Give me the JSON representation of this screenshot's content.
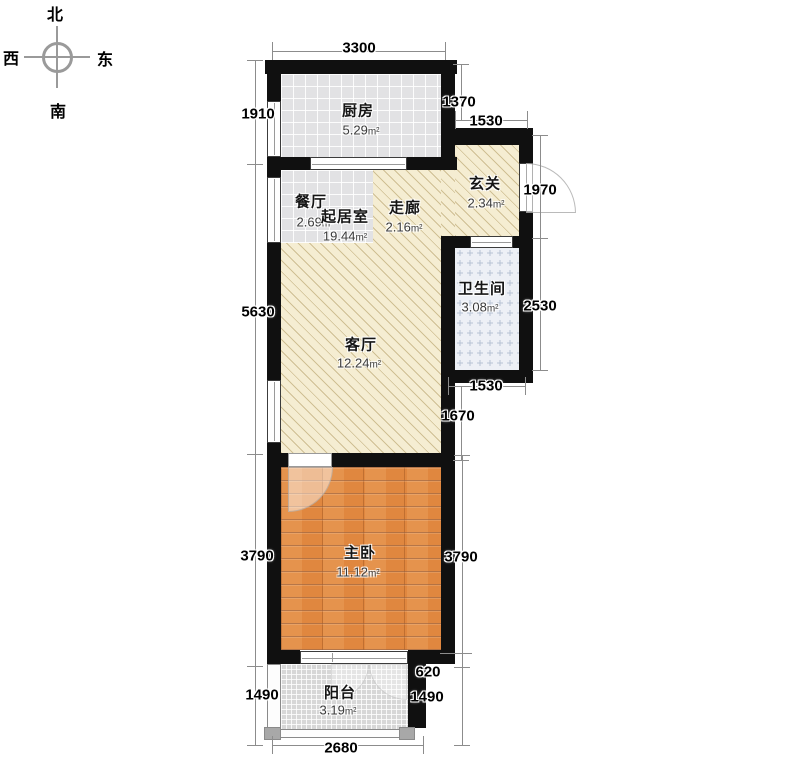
{
  "compass": {
    "north": "北",
    "south": "南",
    "east": "东",
    "west": "西"
  },
  "rooms": {
    "kitchen": {
      "name": "厨房",
      "area": "5.29",
      "unit": "m²"
    },
    "dining": {
      "name": "餐厅",
      "area": "2.69",
      "unit": "m²"
    },
    "living_suite": {
      "name": "起居室",
      "area": "19.44",
      "unit": "m²"
    },
    "corridor": {
      "name": "走廊",
      "area": "2.16",
      "unit": "m²"
    },
    "foyer": {
      "name": "玄关",
      "area": "2.34",
      "unit": "m²"
    },
    "bathroom": {
      "name": "卫生间",
      "area": "3.08",
      "unit": "m²"
    },
    "livingroom": {
      "name": "客厅",
      "area": "12.24",
      "unit": "m²"
    },
    "bedroom": {
      "name": "主卧",
      "area": "11.12",
      "unit": "m²"
    },
    "balcony": {
      "name": "阳台",
      "area": "3.19",
      "unit": "m²"
    }
  },
  "dims": {
    "top_width": "3300",
    "kitchen_left": "1910",
    "kitchen_right": "1370",
    "foyer_top": "1530",
    "foyer_right": "1970",
    "living_left": "5630",
    "bathroom_right": "2530",
    "bathroom_bottom": "1530",
    "living_right": "1670",
    "bedroom_left": "3790",
    "bedroom_right": "3790",
    "balcony_offset": "620",
    "balcony_left": "1490",
    "balcony_right": "1490",
    "bottom_width": "2680"
  },
  "colors": {
    "wall": "#101010",
    "floor-cream": "#f5edd2",
    "tile-gray": "#e2e2e4",
    "wood": "#e0873f",
    "bath-base": "#edf0f6",
    "bath-mark": "#b6c2d4",
    "mesh": "#d7d7d7",
    "dim": "#8c8c8c"
  }
}
